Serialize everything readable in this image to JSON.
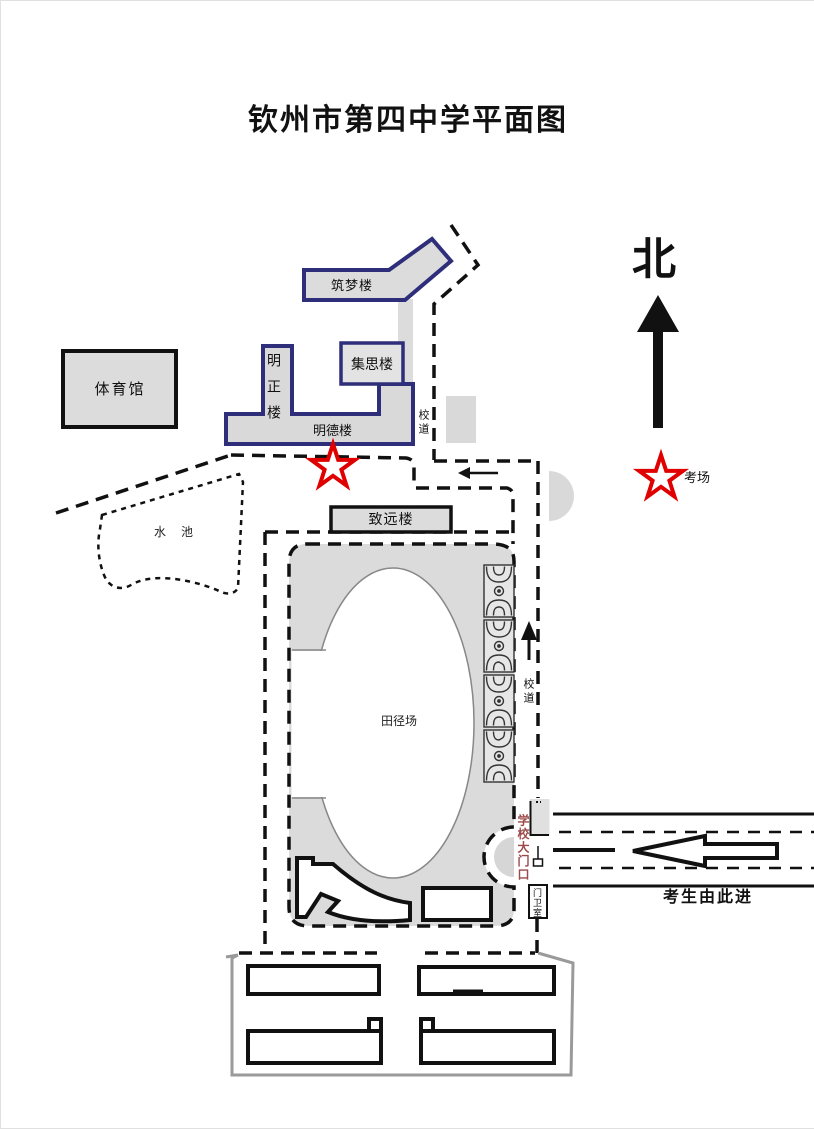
{
  "title": "钦州市第四中学平面图",
  "compass": {
    "north": "北"
  },
  "legend": {
    "star_label": "考场"
  },
  "buildings": {
    "gym": "体育馆",
    "zhumeng": "筑梦楼",
    "mingzheng": "明正楼",
    "jisi": "集思楼",
    "mingde": "明德楼",
    "zhiyuan": "致远楼"
  },
  "areas": {
    "pond": "水 池",
    "field": "田径场"
  },
  "paths": {
    "campus_road_upper": "校道",
    "campus_road_east": "校道"
  },
  "gate": {
    "main_gate": "学校大门口",
    "guard_room": "门卫室",
    "entry_note": "考生由此进"
  },
  "icons": {
    "north_arrow": "thick-up-arrow",
    "exam_star": "red-outline-star",
    "entry_arrow": "left-block-arrow",
    "campus_road_arrows": "small-black-arrows",
    "basketball_court": "court-diagram"
  },
  "colors": {
    "building_fill": "#dcdcdc",
    "building_border_navy": "#2e2e7a",
    "outline_black": "#111111",
    "star_red": "#e00000",
    "gate_text_maroon": "#9c4a4a",
    "compound_wall_gray": "#9a9a9a"
  }
}
